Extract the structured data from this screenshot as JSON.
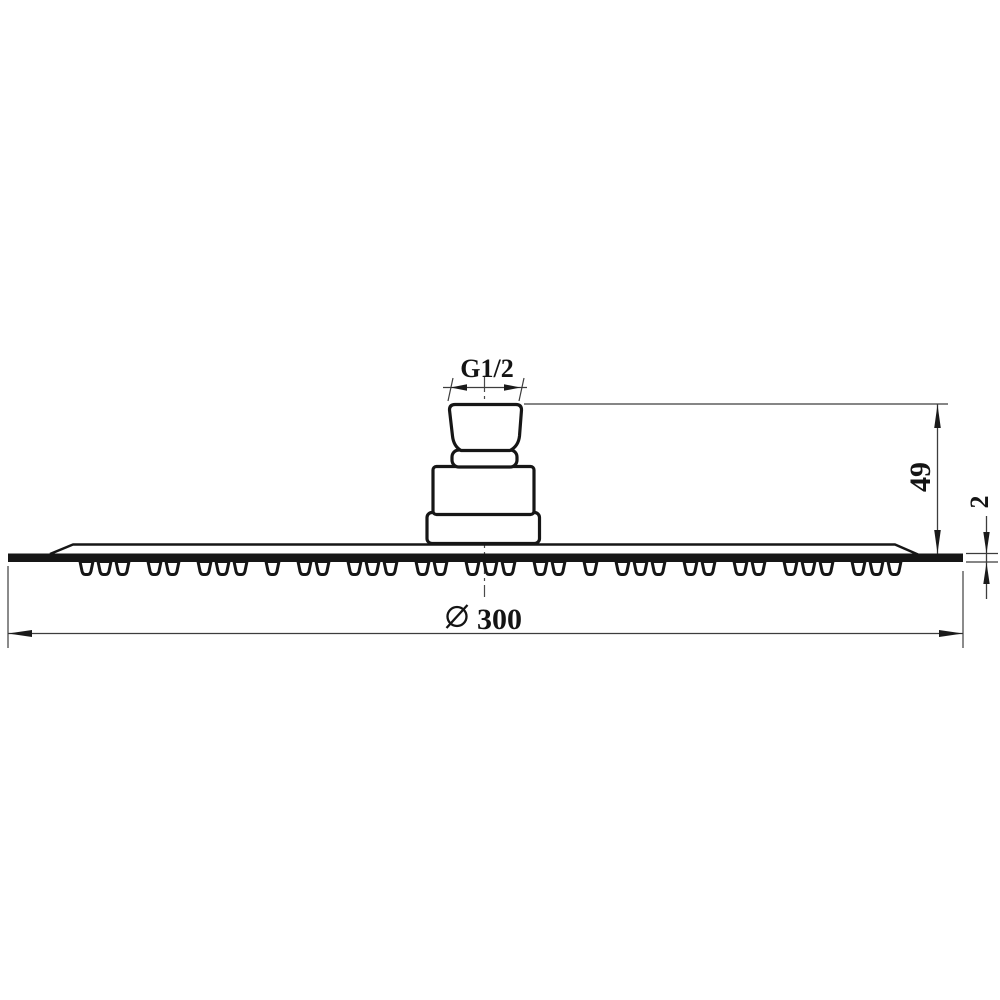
{
  "diagram": {
    "description": "Technical side-view drawing of a slim round rain shower head with top thread connector",
    "labels": {
      "thread": "G1/2",
      "height": "49",
      "edge_thickness": "2",
      "diameter_value": "300",
      "diameter_symbol": "⌀"
    },
    "colors": {
      "background": "#ffffff",
      "object_line": "#161616",
      "dimension_line": "#3d3d3d"
    }
  }
}
